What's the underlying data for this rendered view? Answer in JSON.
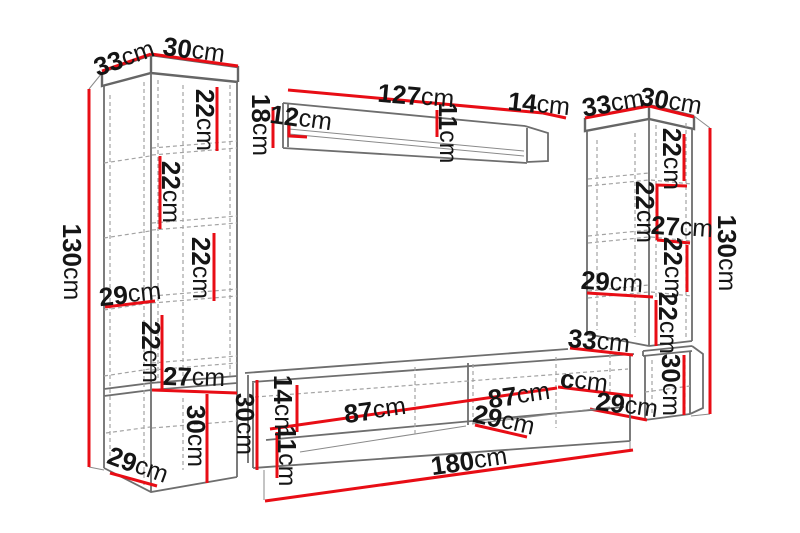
{
  "diagram": {
    "kind": "furniture-dimension-diagram",
    "unit": "cm",
    "colors": {
      "dimension_line": "#e80d15",
      "outline": "#6e6e6e",
      "dashed": "#a3a3a3",
      "text": "#151515",
      "background": "#ffffff"
    },
    "pieces": [
      {
        "name": "left-tall-cabinet",
        "width": "30cm",
        "depth": "33cm",
        "height": "130cm",
        "sections": [
          "22cm",
          "22cm",
          "22cm",
          "29cm",
          "22cm",
          "27cm",
          "30cm",
          "29cm"
        ]
      },
      {
        "name": "wall-shelf",
        "length": "127cm",
        "end_depth": "14cm",
        "height": "18cm",
        "inner": [
          "12cm",
          "11cm"
        ]
      },
      {
        "name": "right-tall-cabinet",
        "width": "30cm",
        "depth": "33cm",
        "height": "130cm",
        "sections": [
          "22cm",
          "22cm",
          "27cm",
          "22cm",
          "29cm",
          "22cm",
          "30cm",
          "29cm"
        ]
      },
      {
        "name": "tv-stand",
        "length": "180cm",
        "top_edge": "33cm",
        "sections": [
          "87cm",
          "87cm",
          "ccm",
          "29cm",
          "30cm",
          "14cm",
          "11cm"
        ]
      }
    ]
  },
  "labels": [
    {
      "part": "left-cabinet",
      "num": "33",
      "unit": "cm"
    },
    {
      "part": "left-cabinet",
      "num": "30",
      "unit": "cm"
    },
    {
      "part": "left-cabinet",
      "num": "130",
      "unit": "cm"
    },
    {
      "part": "left-cabinet",
      "num": "22",
      "unit": "cm"
    },
    {
      "part": "left-cabinet",
      "num": "22",
      "unit": "cm"
    },
    {
      "part": "left-cabinet",
      "num": "22",
      "unit": "cm"
    },
    {
      "part": "left-cabinet",
      "num": "29",
      "unit": "cm"
    },
    {
      "part": "left-cabinet",
      "num": "22",
      "unit": "cm"
    },
    {
      "part": "left-cabinet",
      "num": "27",
      "unit": "cm"
    },
    {
      "part": "left-cabinet",
      "num": "30",
      "unit": "cm"
    },
    {
      "part": "left-cabinet",
      "num": "29",
      "unit": "cm"
    },
    {
      "part": "wall-shelf",
      "num": "127",
      "unit": "cm"
    },
    {
      "part": "wall-shelf",
      "num": "14",
      "unit": "cm"
    },
    {
      "part": "wall-shelf",
      "num": "18",
      "unit": "cm"
    },
    {
      "part": "wall-shelf",
      "num": "12",
      "unit": "cm"
    },
    {
      "part": "wall-shelf",
      "num": "11",
      "unit": "cm"
    },
    {
      "part": "right-cabinet",
      "num": "33",
      "unit": "cm"
    },
    {
      "part": "right-cabinet",
      "num": "30",
      "unit": "cm"
    },
    {
      "part": "right-cabinet",
      "num": "130",
      "unit": "cm"
    },
    {
      "part": "right-cabinet",
      "num": "22",
      "unit": "cm"
    },
    {
      "part": "right-cabinet",
      "num": "22",
      "unit": "cm"
    },
    {
      "part": "right-cabinet",
      "num": "27",
      "unit": "cm"
    },
    {
      "part": "right-cabinet",
      "num": "22",
      "unit": "cm"
    },
    {
      "part": "right-cabinet",
      "num": "29",
      "unit": "cm"
    },
    {
      "part": "right-cabinet",
      "num": "22",
      "unit": "cm"
    },
    {
      "part": "right-cabinet",
      "num": "30",
      "unit": "cm"
    },
    {
      "part": "right-cabinet",
      "num": "29",
      "unit": "cm"
    },
    {
      "part": "tv-stand",
      "num": "33",
      "unit": "cm"
    },
    {
      "part": "tv-stand",
      "num": "c",
      "unit": "cm"
    },
    {
      "part": "tv-stand",
      "num": "87",
      "unit": "cm"
    },
    {
      "part": "tv-stand",
      "num": "87",
      "unit": "cm"
    },
    {
      "part": "tv-stand",
      "num": "29",
      "unit": "cm"
    },
    {
      "part": "tv-stand",
      "num": "30",
      "unit": "cm"
    },
    {
      "part": "tv-stand",
      "num": "14",
      "unit": "cm"
    },
    {
      "part": "tv-stand",
      "num": "11",
      "unit": "cm"
    },
    {
      "part": "tv-stand",
      "num": "180",
      "unit": "cm"
    }
  ]
}
